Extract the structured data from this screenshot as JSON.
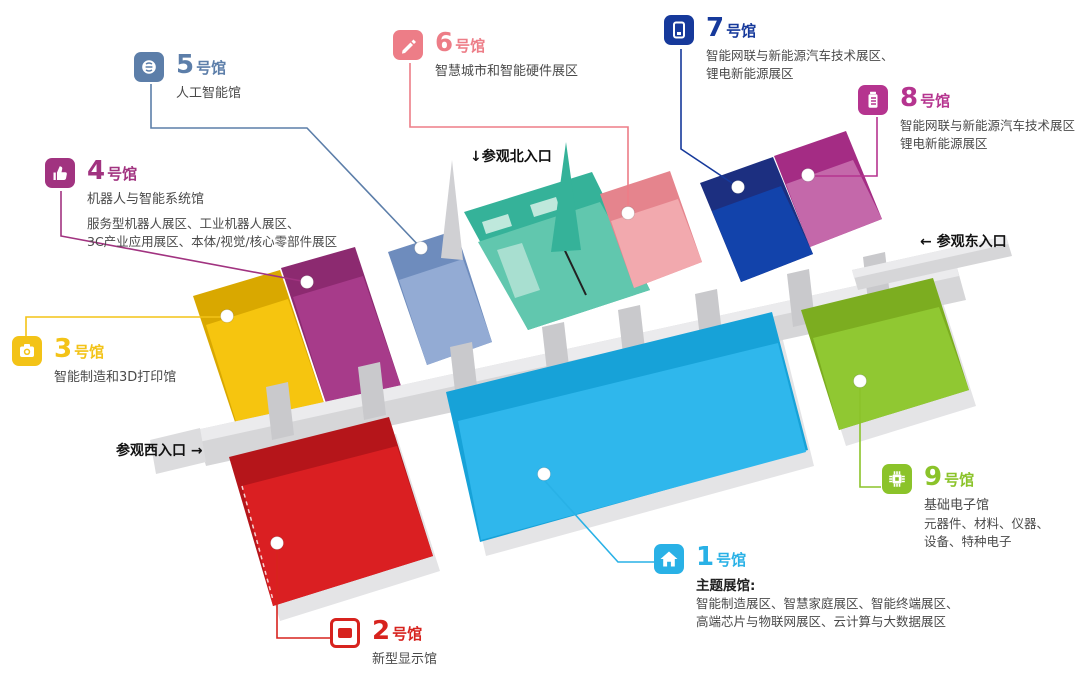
{
  "title": "展馆分布图",
  "entrances": {
    "north": "↓参观北入口",
    "east": "← 参观东入口",
    "west": "参观西入口 →"
  },
  "palette": {
    "corridor": "#d6d6d8",
    "corridor_light": "#ebebed",
    "stub": "#c9c9cc",
    "skirt": "#e4e4e6",
    "teal_wall": "#35b299",
    "teal_floor": "#61c7ae",
    "teal_booth": "#bfe8dc",
    "text_dark": "#111111",
    "text_body": "#4a4a4a"
  },
  "halls": [
    {
      "id": 1,
      "num": "1",
      "unit": "号馆",
      "name": "主题展馆:",
      "desc": [
        "智能制造展区、智慧家庭展区、智能终端展区、",
        "高端芯片与物联网展区、云计算与大数据展区"
      ],
      "icon": "home-icon",
      "colors": {
        "accent": "#29b1e6",
        "wall": "#17a2d8",
        "floor": "#2fb7ec"
      }
    },
    {
      "id": 2,
      "num": "2",
      "unit": "号馆",
      "name": "新型显示馆",
      "desc": [],
      "icon": "display-icon",
      "colors": {
        "accent": "#d7231e",
        "wall": "#b5151a",
        "floor": "#da1f22"
      }
    },
    {
      "id": 3,
      "num": "3",
      "unit": "号馆",
      "name": "智能制造和3D打印馆",
      "desc": [],
      "icon": "camera-icon",
      "colors": {
        "accent": "#f3c317",
        "wall": "#d9a800",
        "floor": "#f6c50f"
      }
    },
    {
      "id": 4,
      "num": "4",
      "unit": "号馆",
      "name": "机器人与智能系统馆",
      "desc": [
        "服务型机器人展区、工业机器人展区、",
        "3C产业应用展区、本体/视觉/核心零部件展区"
      ],
      "icon": "thumbs-up-icon",
      "colors": {
        "accent": "#a13380",
        "wall": "#8c2a70",
        "floor": "#a73b8a"
      }
    },
    {
      "id": 5,
      "num": "5",
      "unit": "号馆",
      "name": "人工智能馆",
      "desc": [],
      "icon": "brain-icon",
      "colors": {
        "accent": "#5c7ea9",
        "wall": "#6e8cbd",
        "floor": "#93abd4"
      }
    },
    {
      "id": 6,
      "num": "6",
      "unit": "号馆",
      "name": "智慧城市和智能硬件展区",
      "desc": [],
      "icon": "pen-icon",
      "colors": {
        "accent": "#ed7d87",
        "wall": "#e5848d",
        "floor": "#f2a9ae"
      }
    },
    {
      "id": 7,
      "num": "7",
      "unit": "号馆",
      "name": "",
      "desc": [
        "智能网联与新能源汽车技术展区、",
        "锂电新能源展区"
      ],
      "icon": "device-icon",
      "colors": {
        "accent": "#16399b",
        "wall": "#1c2f80",
        "floor": "#1243ab"
      }
    },
    {
      "id": 8,
      "num": "8",
      "unit": "号馆",
      "name": "",
      "desc": [
        "智能网联与新能源汽车技术展区",
        "锂电新能源展区"
      ],
      "icon": "battery-icon",
      "colors": {
        "accent": "#b5348f",
        "wall": "#a42c84",
        "floor": "#c468aa"
      }
    },
    {
      "id": 9,
      "num": "9",
      "unit": "号馆",
      "name": "基础电子馆",
      "desc": [
        "元器件、材料、仪器、",
        "设备、特种电子"
      ],
      "icon": "chip-icon",
      "colors": {
        "accent": "#8bc32a",
        "wall": "#7cad20",
        "floor": "#90c832"
      }
    }
  ]
}
